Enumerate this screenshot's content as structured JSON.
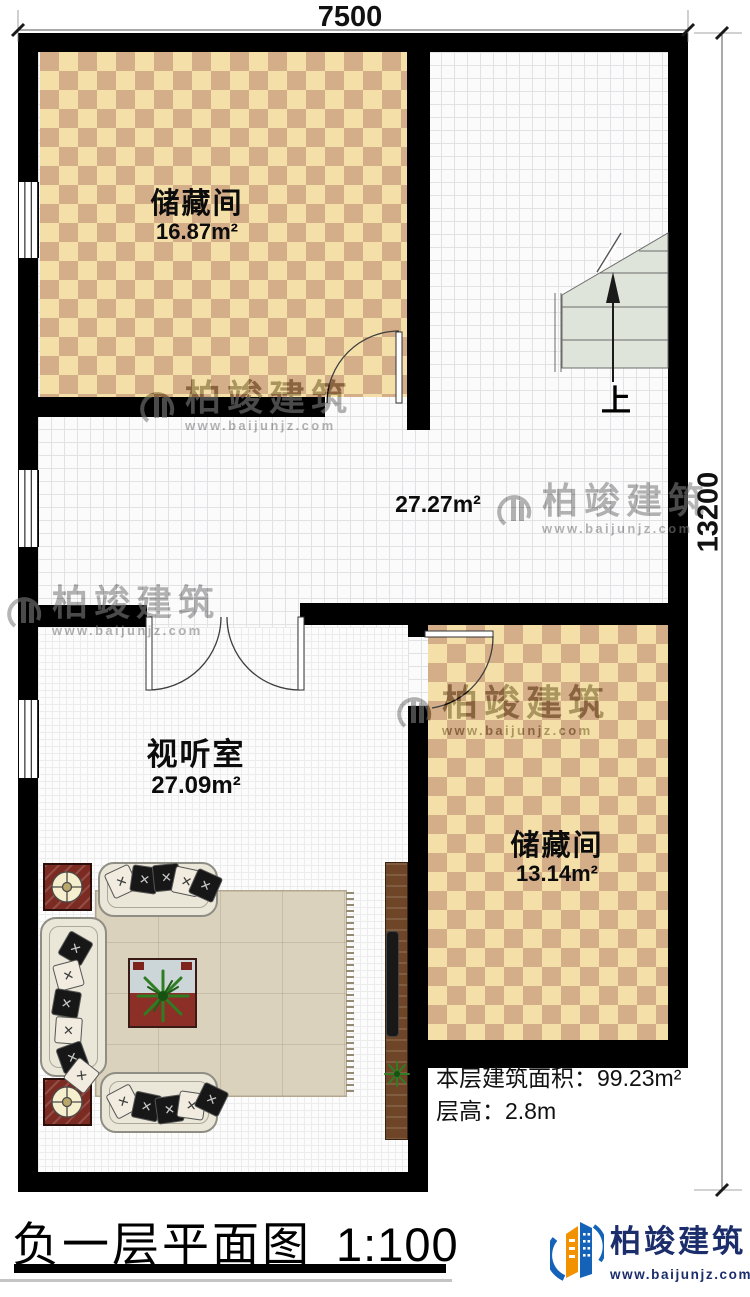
{
  "plan": {
    "dimensions": {
      "width_mm": "7500",
      "height_mm": "13200"
    },
    "rooms": {
      "storage_top": {
        "name": "储藏间",
        "area": "16.87m²"
      },
      "hall": {
        "area": "27.27m²"
      },
      "av_room": {
        "name": "视听室",
        "area": "27.09m²"
      },
      "storage_right": {
        "name": "储藏间",
        "area": "13.14m²"
      }
    },
    "stairs": {
      "up_label": "上"
    },
    "notes": {
      "floor_area": "本层建筑面积：99.23m²",
      "floor_height": "层高：2.8m"
    }
  },
  "footer": {
    "title": "负一层平面图",
    "scale": "1:100"
  },
  "brand": {
    "company": "柏竣建筑",
    "website": "www.baijunjz.com"
  },
  "watermark": {
    "company": "柏竣建筑",
    "website": "www.baijunjz.com"
  },
  "colors": {
    "wall": "#000000",
    "checker_light": "#f5dfa9",
    "checker_dark": "#d4ae89",
    "stair_fill": "#dfe4da",
    "logo_blue": "#1463b8",
    "logo_orange": "#f39200",
    "logo_text": "#1b2d6b"
  }
}
